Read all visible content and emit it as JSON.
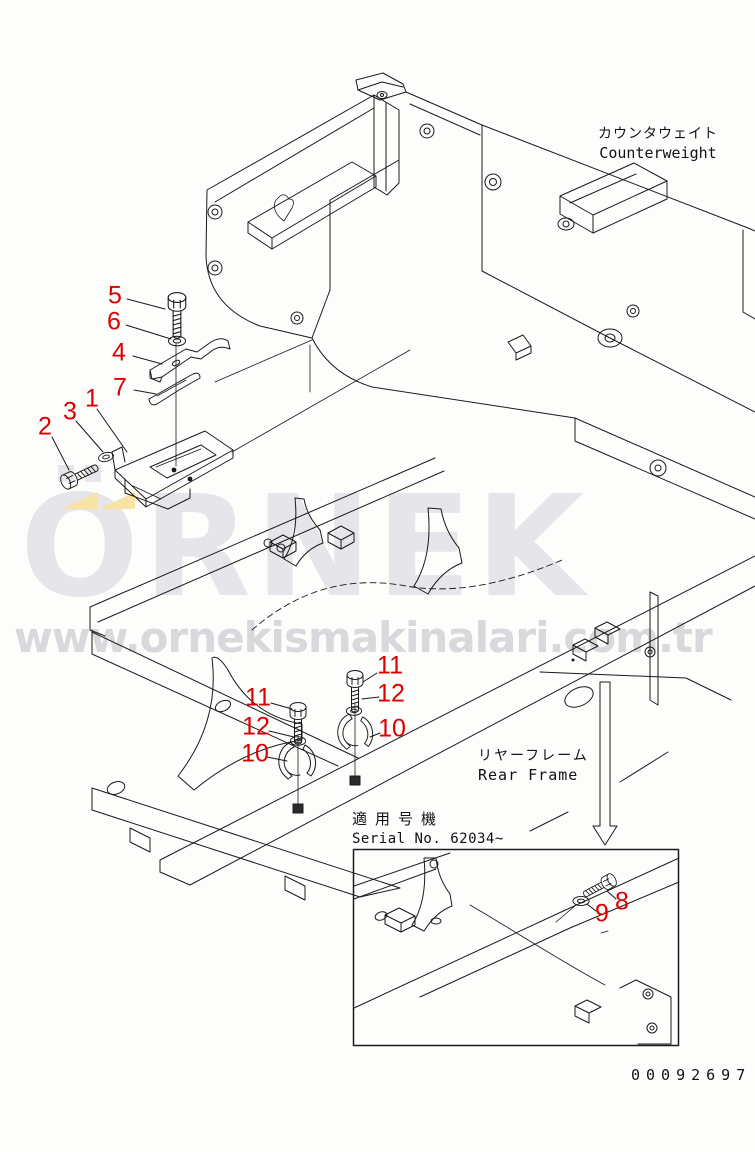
{
  "figure": {
    "type": "parts-catalog-exploded-diagram",
    "background_color": "#fdfdfb",
    "line_color": "#1a1a1a",
    "doc_number": "00092697"
  },
  "labels": {
    "counterweight": {
      "jp": "カウンタウェイト",
      "en": "Counterweight"
    },
    "rear_frame": {
      "jp": "リヤーフレーム",
      "en": "Rear Frame"
    },
    "serial": {
      "jp": "適用号機",
      "en": "Serial No. 62034~"
    }
  },
  "watermark": {
    "brand": "ÖRNEK",
    "url": "www.ornekismakinalari.com.tr",
    "brand_color": "#e5e5ea",
    "url_color": "#d8d8dd",
    "accent_color": "#f7e3a3"
  },
  "callouts": {
    "color": "#dd0000",
    "items": [
      {
        "label": "5"
      },
      {
        "label": "6"
      },
      {
        "label": "4"
      },
      {
        "label": "7"
      },
      {
        "label": "1"
      },
      {
        "label": "3"
      },
      {
        "label": "2"
      },
      {
        "label": "11"
      },
      {
        "label": "12"
      },
      {
        "label": "10"
      },
      {
        "label": "11"
      },
      {
        "label": "12"
      },
      {
        "label": "10"
      },
      {
        "label": "8"
      },
      {
        "label": "9"
      }
    ]
  }
}
